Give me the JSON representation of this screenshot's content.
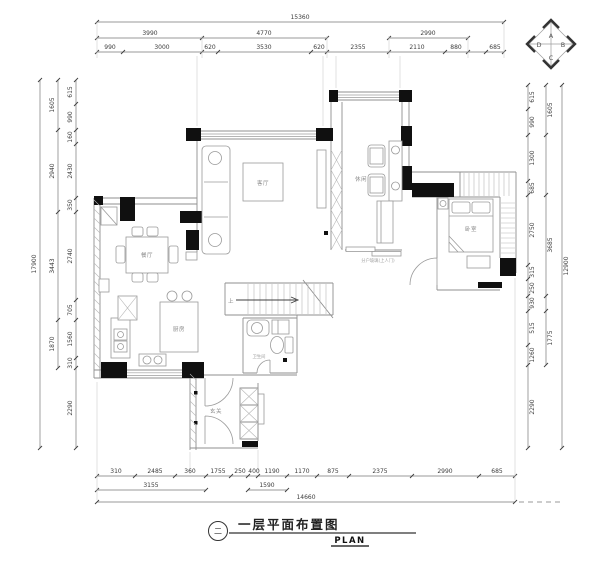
{
  "title": {
    "bubble_label": "二",
    "cn": "一层平面布置图",
    "en": "PLAN"
  },
  "compass": {
    "top": "A",
    "right": "B",
    "bottom": "C",
    "left": "D"
  },
  "rooms": {
    "living": "客厅",
    "lounge": "休闲",
    "bedroom": "卧室",
    "dining": "餐厅",
    "kitchen": "厨房",
    "bath": "卫生间",
    "entry": "玄关",
    "stairs_up": "上"
  },
  "notes": {
    "glass": "分户玻璃(上人门)"
  },
  "dims": {
    "top": {
      "total": "15360",
      "row2": [
        "3990",
        "4770",
        "2990"
      ],
      "row3": [
        "990",
        "3000",
        "620",
        "3530",
        "620",
        "2355",
        "2110",
        "880",
        "685"
      ]
    },
    "left": {
      "total": "17900",
      "mid": [
        "1605",
        "2940",
        "3443",
        "1870"
      ],
      "inner": [
        "615",
        "990",
        "160",
        "2430",
        "350",
        "2740",
        "705",
        "1560",
        "310",
        "2290"
      ]
    },
    "right": {
      "total": "12900",
      "mid": [
        "1605",
        "3685",
        "1775"
      ],
      "inner": [
        "615",
        "990",
        "1300",
        "685",
        "2750",
        "315",
        "250",
        "930",
        "515",
        "1260",
        "2290"
      ]
    },
    "bottom": {
      "total": "14660",
      "row2": [
        "3155",
        "1590"
      ],
      "row1": [
        "310",
        "2485",
        "360",
        "1755",
        "250",
        "400",
        "1190",
        "1170",
        "875",
        "2375",
        "2990",
        "685"
      ]
    }
  }
}
